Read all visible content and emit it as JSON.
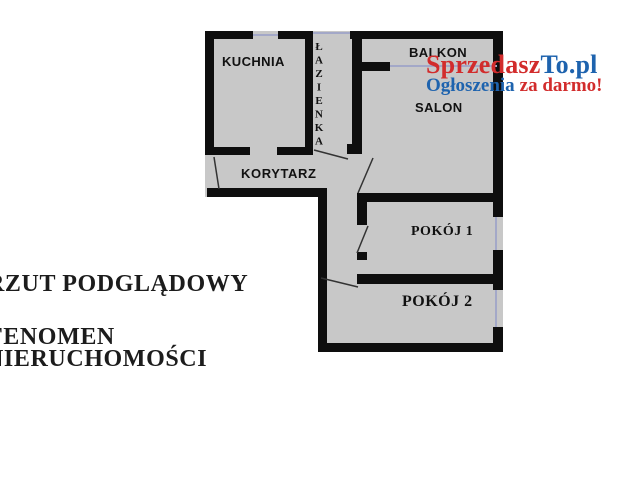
{
  "plan": {
    "rooms": {
      "kitchen": "KUCHNIA",
      "bathroom": "ŁAZIENKA",
      "balcony": "BALKON",
      "living_room": "SALON",
      "corridor": "KORYTARZ",
      "room1": "POKÓJ 1",
      "room2": "POKÓJ 2"
    }
  },
  "watermark": {
    "brand_red": "Sprzedasz",
    "brand_blue": "To.pl",
    "tagline_blue": "Ogłoszenia",
    "tagline_red": "za darmo!"
  },
  "captions": {
    "line1": "RZUT PODGLĄDOWY",
    "line2": "FENOMEN",
    "line3": "NIERUCHOMOŚCI"
  },
  "colors": {
    "brand_red": "#d22c2c",
    "brand_blue": "#1e63ae",
    "floor_fill": "#c8c8c8",
    "wall": "#0e0e0e",
    "window_line": "#a3a8c8",
    "door_line": "#333333",
    "ink": "#1c1c1c"
  }
}
